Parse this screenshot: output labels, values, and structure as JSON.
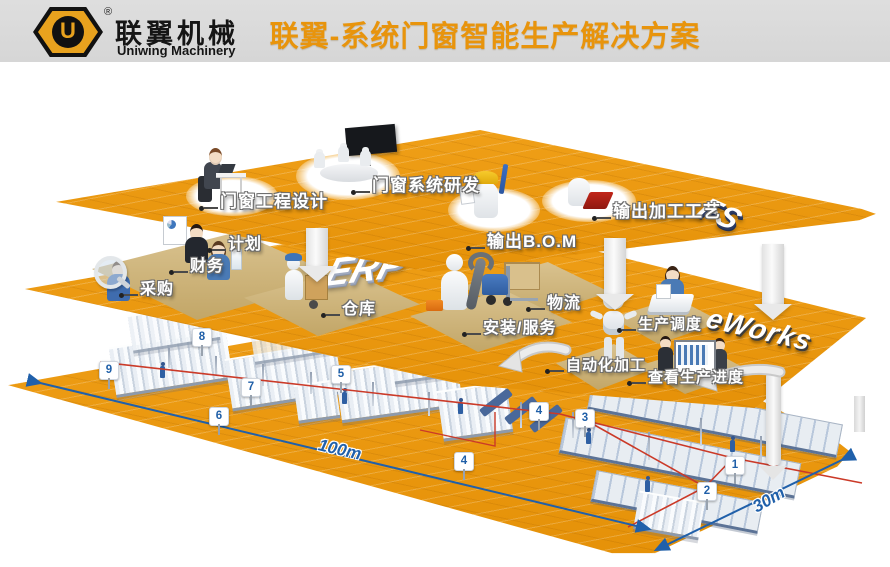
{
  "header": {
    "brand_cn": "联翼机械",
    "brand_en": "Uniwing Machinery",
    "registered_mark": "®",
    "logo_letter": "U",
    "title": "联翼-系统门窗智能生产解决方案"
  },
  "colors": {
    "platform_orange": "#ED9A10",
    "title_orange": "#E8940C",
    "marker_blue": "#1F5FA8",
    "route_red": "#CB3A28",
    "dimension_blue": "#2060AA",
    "pad_tan": "#CDB37C"
  },
  "layers": {
    "fs": {
      "badge": "FS",
      "stations": [
        {
          "label": "门窗工程设计"
        },
        {
          "label": "门窗系统研发"
        },
        {
          "label": "输出B.O.M"
        },
        {
          "label": "输出加工工艺"
        }
      ]
    },
    "erp": {
      "badge": "ERP",
      "stations": [
        {
          "label": "计划"
        },
        {
          "label": "财务"
        },
        {
          "label": "采购"
        },
        {
          "label": "仓库"
        },
        {
          "label": "物流"
        },
        {
          "label": "安装/服务"
        },
        {
          "label": "生产调度"
        }
      ]
    },
    "eworks": {
      "badge": "eWorks",
      "stations": [
        {
          "label": "自动化加工"
        },
        {
          "label": "查看生产进度"
        }
      ],
      "markers": [
        {
          "num": "8"
        },
        {
          "num": "9"
        },
        {
          "num": "7"
        },
        {
          "num": "6"
        },
        {
          "num": "5"
        },
        {
          "num": "4"
        },
        {
          "num": "4"
        },
        {
          "num": "3"
        },
        {
          "num": "1"
        },
        {
          "num": "2"
        }
      ],
      "dimensions": {
        "length": "100m",
        "width": "30m"
      }
    }
  }
}
